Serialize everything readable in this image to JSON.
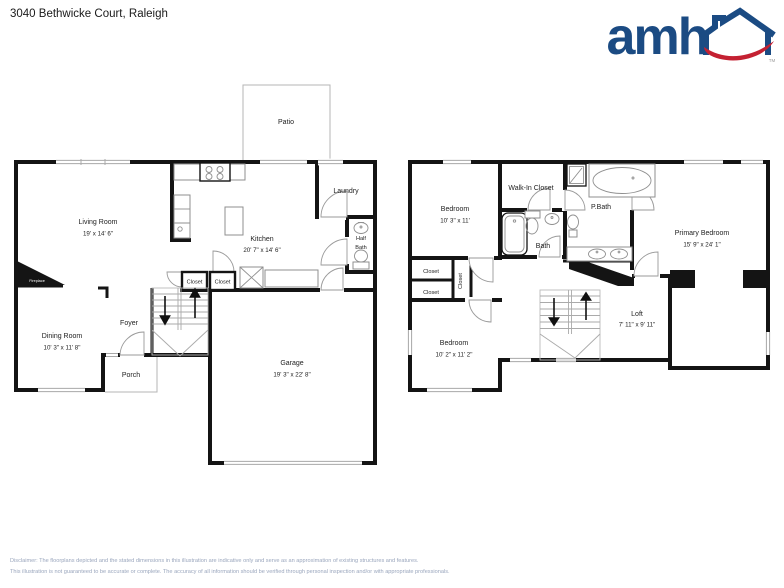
{
  "header": {
    "address": "3040 Bethwicke Court, Raleigh"
  },
  "logo": {
    "text": "amh",
    "tm": "TM"
  },
  "colors": {
    "logo_blue": "#1b4b83",
    "logo_red": "#c42132",
    "wall": "#141414",
    "disclaimer_text": "#9aa6bd"
  },
  "floor1": {
    "patio": {
      "name": "Patio"
    },
    "living_room": {
      "name": "Living Room",
      "dims": "19' x 14' 6\""
    },
    "kitchen": {
      "name": "Kitchen",
      "dims": "20' 7\" x 14' 6\""
    },
    "laundry": {
      "name": "Laundry"
    },
    "half_bath": {
      "line1": "Half",
      "line2": "Bath"
    },
    "closet_a": {
      "name": "Closet"
    },
    "closet_b": {
      "name": "Closet"
    },
    "foyer": {
      "name": "Foyer"
    },
    "dining_room": {
      "name": "Dining Room",
      "dims": "10' 3\" x 11' 8\""
    },
    "porch": {
      "name": "Porch"
    },
    "garage": {
      "name": "Garage",
      "dims": "19' 3\" x 22' 8\""
    },
    "fireplace": {
      "name": "Fireplace"
    }
  },
  "floor2": {
    "bedroom_top": {
      "name": "Bedroom",
      "dims": "10' 3\" x 11'"
    },
    "walk_in_closet": {
      "name": "Walk-In Closet"
    },
    "primary_bath": {
      "name": "P.Bath"
    },
    "bath": {
      "name": "Bath"
    },
    "primary_bedroom": {
      "name": "Primary Bedroom",
      "dims": "15' 9\" x 24' 1\""
    },
    "closet_a": {
      "name": "Closet"
    },
    "closet_b": {
      "name": "Closet"
    },
    "closet_c": {
      "name": "Closet"
    },
    "bedroom_bottom": {
      "name": "Bedroom",
      "dims": "10' 2\" x 11' 2\""
    },
    "loft": {
      "name": "Loft",
      "dims": "7' 11\" x 9' 11\""
    }
  },
  "disclaimer": {
    "line1": "Disclaimer: The floorplans depicted and the stated dimensions in this illustration are indicative only and serve as an approximation of existing structures and features.",
    "line2": "This illustration is not guaranteed to be accurate or complete. The accuracy of all information should be verified through personal inspection and/or with appropriate professionals."
  }
}
